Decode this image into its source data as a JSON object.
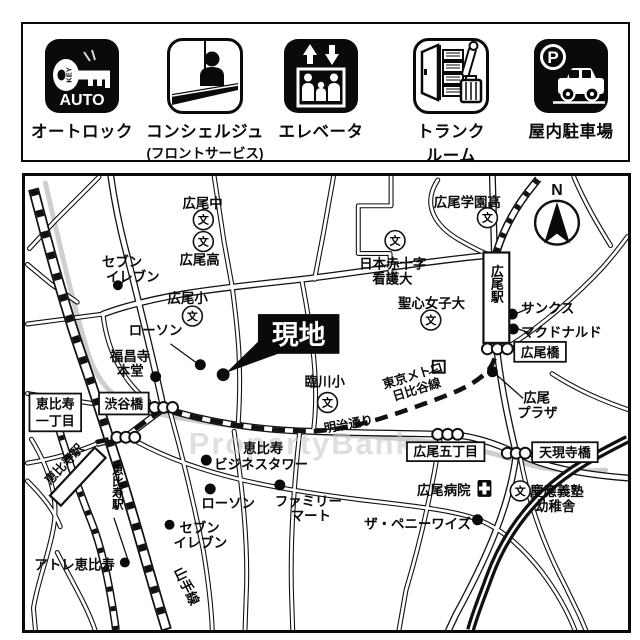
{
  "amenities": {
    "items": [
      {
        "label": "オートロック"
      },
      {
        "label": "コンシェルジュ",
        "label2": "(フロントサービス)"
      },
      {
        "label": "エレベータ"
      },
      {
        "label": "トランク",
        "label2": "ルーム"
      },
      {
        "label": "屋内駐車場"
      }
    ],
    "key_badge": "AUTO",
    "key_text": "KEY",
    "parking_p": "P"
  },
  "map": {
    "site": {
      "label": "現地"
    },
    "compass": {
      "n": "N"
    },
    "watermark": "PropertyBank",
    "school_char": "文",
    "boxed": [
      {
        "line1": "恵比寿",
        "line2": "一丁目"
      },
      {
        "label": "渋谷橋"
      },
      {
        "label": "広尾橋"
      },
      {
        "label": "広尾五丁目"
      },
      {
        "label": "天現寺橋"
      }
    ],
    "stations": {
      "hiroo": "広尾駅",
      "ebisu_vertical": "恵比寿駅",
      "ebisu_building": "恵比寿駅"
    },
    "lines": {
      "yamanote": "山手線",
      "meiji_dori": "明治通り",
      "metro1": "東京メトロ",
      "metro2": "日比谷線"
    },
    "hospital": {
      "label": "広尾病院"
    },
    "pois": [
      {
        "line1": "セブン",
        "line2": "イレブン"
      },
      {
        "line1": "ローソン"
      },
      {
        "line1": "福昌寺",
        "line2": "本堂"
      },
      {
        "line1": "恵比寿",
        "line2": "ビジネスタワー"
      },
      {
        "line1": "ローソン"
      },
      {
        "line1": "ファミリー",
        "line2": "マート"
      },
      {
        "line1": "セブン",
        "line2": "イレブン"
      },
      {
        "line1": "アトレ恵比寿"
      },
      {
        "line1": "サンクス"
      },
      {
        "line1": "マクドナルド"
      },
      {
        "line1": "広尾",
        "line2": "プラザ"
      },
      {
        "line1": "ザ・ペニーワイズ"
      }
    ],
    "schools": [
      {
        "label": "広尾中"
      },
      {
        "label": "広尾高"
      },
      {
        "label": "広尾小"
      },
      {
        "label": "臨川小"
      },
      {
        "label": "広尾学園高"
      },
      {
        "line1": "日本赤十字",
        "line2": "看護大"
      },
      {
        "label": "聖心女子大"
      },
      {
        "line1": "慶應義塾",
        "line2": "幼稚舎"
      }
    ]
  }
}
